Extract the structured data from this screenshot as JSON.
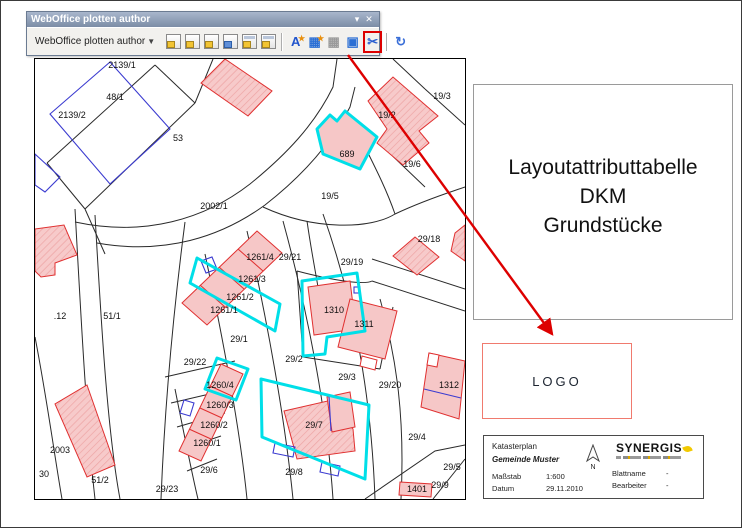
{
  "window": {
    "title": "WebOffice plotten author",
    "minimize_icon": "▾",
    "close_icon": "✕"
  },
  "toolbar": {
    "dropdown_label": "WebOffice plotten author",
    "dropdown_caret": "▼",
    "icons": [
      {
        "name": "plot-pdf-icon",
        "kind": "page"
      },
      {
        "name": "plot-print-icon",
        "kind": "page"
      },
      {
        "name": "plot-print-settings-icon",
        "kind": "page"
      },
      {
        "name": "plot-export-icon",
        "kind": "pageblue"
      },
      {
        "name": "save-plot-icon",
        "kind": "pagedisk"
      },
      {
        "name": "save-plot-as-icon",
        "kind": "pagedisk"
      },
      {
        "name": "separator"
      },
      {
        "name": "text-element-icon",
        "kind": "glyph",
        "glyph": "A",
        "color": "#2255cc",
        "badge": true
      },
      {
        "name": "new-attribute-table-icon",
        "kind": "glyph",
        "glyph": "▦",
        "color": "#2b6fd4",
        "badge": true
      },
      {
        "name": "attribute-table-icon",
        "kind": "glyph",
        "glyph": "▦",
        "color": "#9a9a9a"
      },
      {
        "name": "layout-window-icon",
        "kind": "glyph",
        "glyph": "▣",
        "color": "#2b6fd4"
      },
      {
        "name": "edit-layout-element-icon",
        "kind": "glyph",
        "glyph": "✂",
        "color": "#2b5fd0",
        "highlight": true
      },
      {
        "name": "separator"
      },
      {
        "name": "refresh-icon",
        "kind": "glyph",
        "glyph": "↻",
        "color": "#3a6fd8"
      }
    ]
  },
  "map": {
    "highlight_color": "#00dfe8",
    "building_fill": "#f6c7c7",
    "building_outline": "#e03030",
    "labels": [
      {
        "t": "2139/1",
        "x": 87,
        "y": 6
      },
      {
        "t": "48/1",
        "x": 80,
        "y": 38
      },
      {
        "t": "2139/2",
        "x": 37,
        "y": 56
      },
      {
        "t": "53",
        "x": 143,
        "y": 79
      },
      {
        "t": "2002/1",
        "x": 179,
        "y": 147
      },
      {
        "t": "19/2",
        "x": 352,
        "y": 56
      },
      {
        "t": "19/3",
        "x": 407,
        "y": 37
      },
      {
        "t": "689",
        "x": 312,
        "y": 95
      },
      {
        "t": "19/6",
        "x": 377,
        "y": 105
      },
      {
        "t": "19/5",
        "x": 295,
        "y": 137
      },
      {
        "t": "29/18",
        "x": 394,
        "y": 180
      },
      {
        "t": "1261/4",
        "x": 225,
        "y": 198
      },
      {
        "t": "29/21",
        "x": 255,
        "y": 198
      },
      {
        "t": "29/19",
        "x": 317,
        "y": 203
      },
      {
        "t": "1261/3",
        "x": 217,
        "y": 220
      },
      {
        "t": "1261/2",
        "x": 205,
        "y": 238
      },
      {
        "t": "1261/1",
        "x": 189,
        "y": 251
      },
      {
        "t": "1310",
        "x": 299,
        "y": 251
      },
      {
        "t": "1311",
        "x": 329,
        "y": 265
      },
      {
        "t": ".12",
        "x": 25,
        "y": 257
      },
      {
        "t": "51/1",
        "x": 77,
        "y": 257
      },
      {
        "t": "29/1",
        "x": 204,
        "y": 280
      },
      {
        "t": "29/2",
        "x": 259,
        "y": 300
      },
      {
        "t": "29/22",
        "x": 160,
        "y": 303
      },
      {
        "t": "29/3",
        "x": 312,
        "y": 318
      },
      {
        "t": "29/20",
        "x": 355,
        "y": 326
      },
      {
        "t": "1312",
        "x": 414,
        "y": 326
      },
      {
        "t": "1260/4",
        "x": 185,
        "y": 326
      },
      {
        "t": "1260/3",
        "x": 185,
        "y": 346
      },
      {
        "t": "1260/2",
        "x": 179,
        "y": 366
      },
      {
        "t": "1260/1",
        "x": 172,
        "y": 384
      },
      {
        "t": "29/7",
        "x": 279,
        "y": 366
      },
      {
        "t": "29/4",
        "x": 382,
        "y": 378
      },
      {
        "t": "29/8",
        "x": 259,
        "y": 413
      },
      {
        "t": "29/5",
        "x": 417,
        "y": 408
      },
      {
        "t": "29/6",
        "x": 174,
        "y": 411
      },
      {
        "t": "2003",
        "x": 25,
        "y": 391
      },
      {
        "t": "30",
        "x": 9,
        "y": 415
      },
      {
        "t": "51/2",
        "x": 65,
        "y": 421
      },
      {
        "t": "29/23",
        "x": 132,
        "y": 430
      },
      {
        "t": "29/9",
        "x": 405,
        "y": 426
      },
      {
        "t": "1401",
        "x": 382,
        "y": 430
      }
    ]
  },
  "layout_box": {
    "lines": [
      "Layoutattributtabelle",
      "DKM",
      "Grundstücke"
    ]
  },
  "logo_box": {
    "text": "LOGO"
  },
  "info_box": {
    "title": "Katasterplan",
    "municipality": "Gemeinde Muster",
    "scale_label": "Maßstab",
    "scale_value": "1:600",
    "date_label": "Datum",
    "date_value": "29.11.2010",
    "sheet_label": "Blattname",
    "sheet_value": "-",
    "editor_label": "Bearbeiter",
    "editor_value": "-",
    "north_label": "N",
    "brand": "SYNERGIS"
  },
  "annotation": {
    "color": "#dd0000"
  }
}
